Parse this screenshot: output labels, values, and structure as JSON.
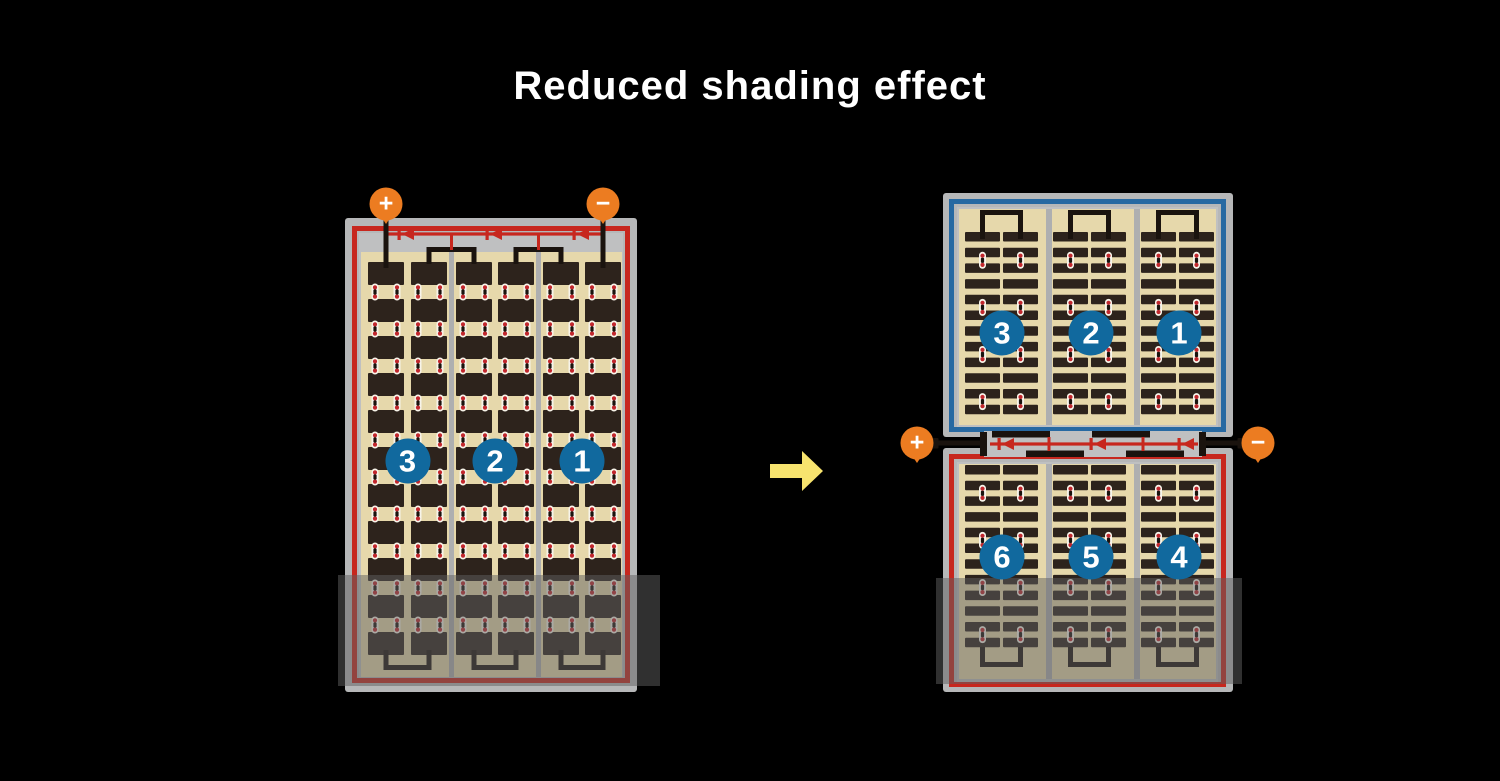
{
  "title": "Reduced shading effect",
  "left_diagram": {
    "terminals": {
      "positive": "+",
      "negative": "−"
    },
    "string_labels": [
      "3",
      "2",
      "1"
    ]
  },
  "right_diagram": {
    "terminals": {
      "positive": "+",
      "negative": "−"
    },
    "top_string_labels": [
      "3",
      "2",
      "1"
    ],
    "bottom_string_labels": [
      "6",
      "5",
      "4"
    ]
  },
  "icons": {
    "arrow": "right-block-arrow",
    "diode": "left-pointing-diode"
  },
  "colors": {
    "background": "#000000",
    "title_text": "#ffffff",
    "frame_gray": "#b6b7b8",
    "inner_gray": "#bfc0c1",
    "divider_gray": "#aeafb0",
    "tan": "#e6d8ab",
    "cell_dark": "#2d231c",
    "red": "#c7271e",
    "blue": "#2769a2",
    "circle_blue": "#11699e",
    "orange": "#ec7c21",
    "yellow": "#f7e36e",
    "pad_white": "#f7f4ea",
    "pad_red": "#c1272d",
    "wire_black": "#1a130e",
    "shade": "rgba(95,95,95,0.5)"
  }
}
